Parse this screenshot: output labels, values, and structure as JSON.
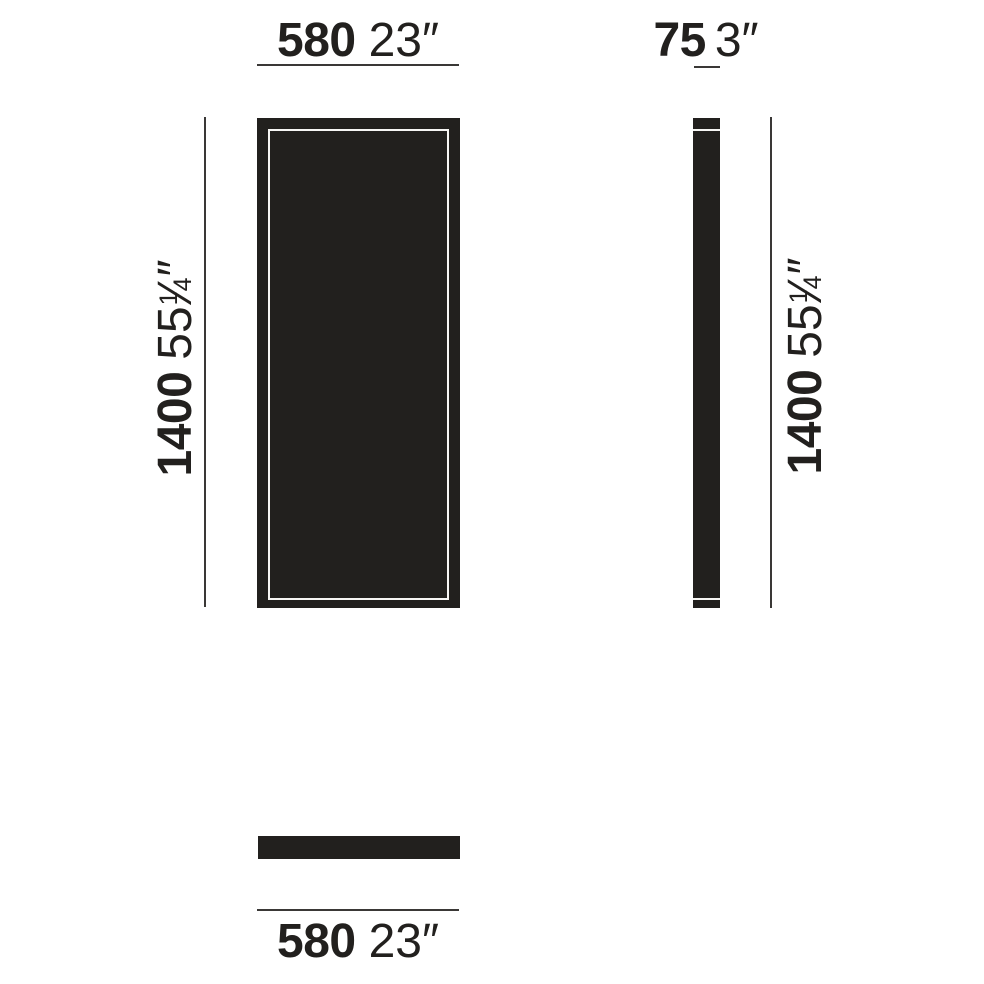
{
  "colors": {
    "ink": "#22201e",
    "dimension_line": "#3a3836",
    "background": "#ffffff",
    "frame_highlight": "#f7f6f4"
  },
  "dims": {
    "width": {
      "metric": "580",
      "imperial": "23″"
    },
    "depth": {
      "metric": "75",
      "imperial": "3″"
    },
    "height": {
      "metric": "1400",
      "imperial_whole": "55",
      "imperial_num": "1",
      "imperial_slash": "⁄",
      "imperial_den": "4",
      "imperial_unit": "″"
    }
  }
}
